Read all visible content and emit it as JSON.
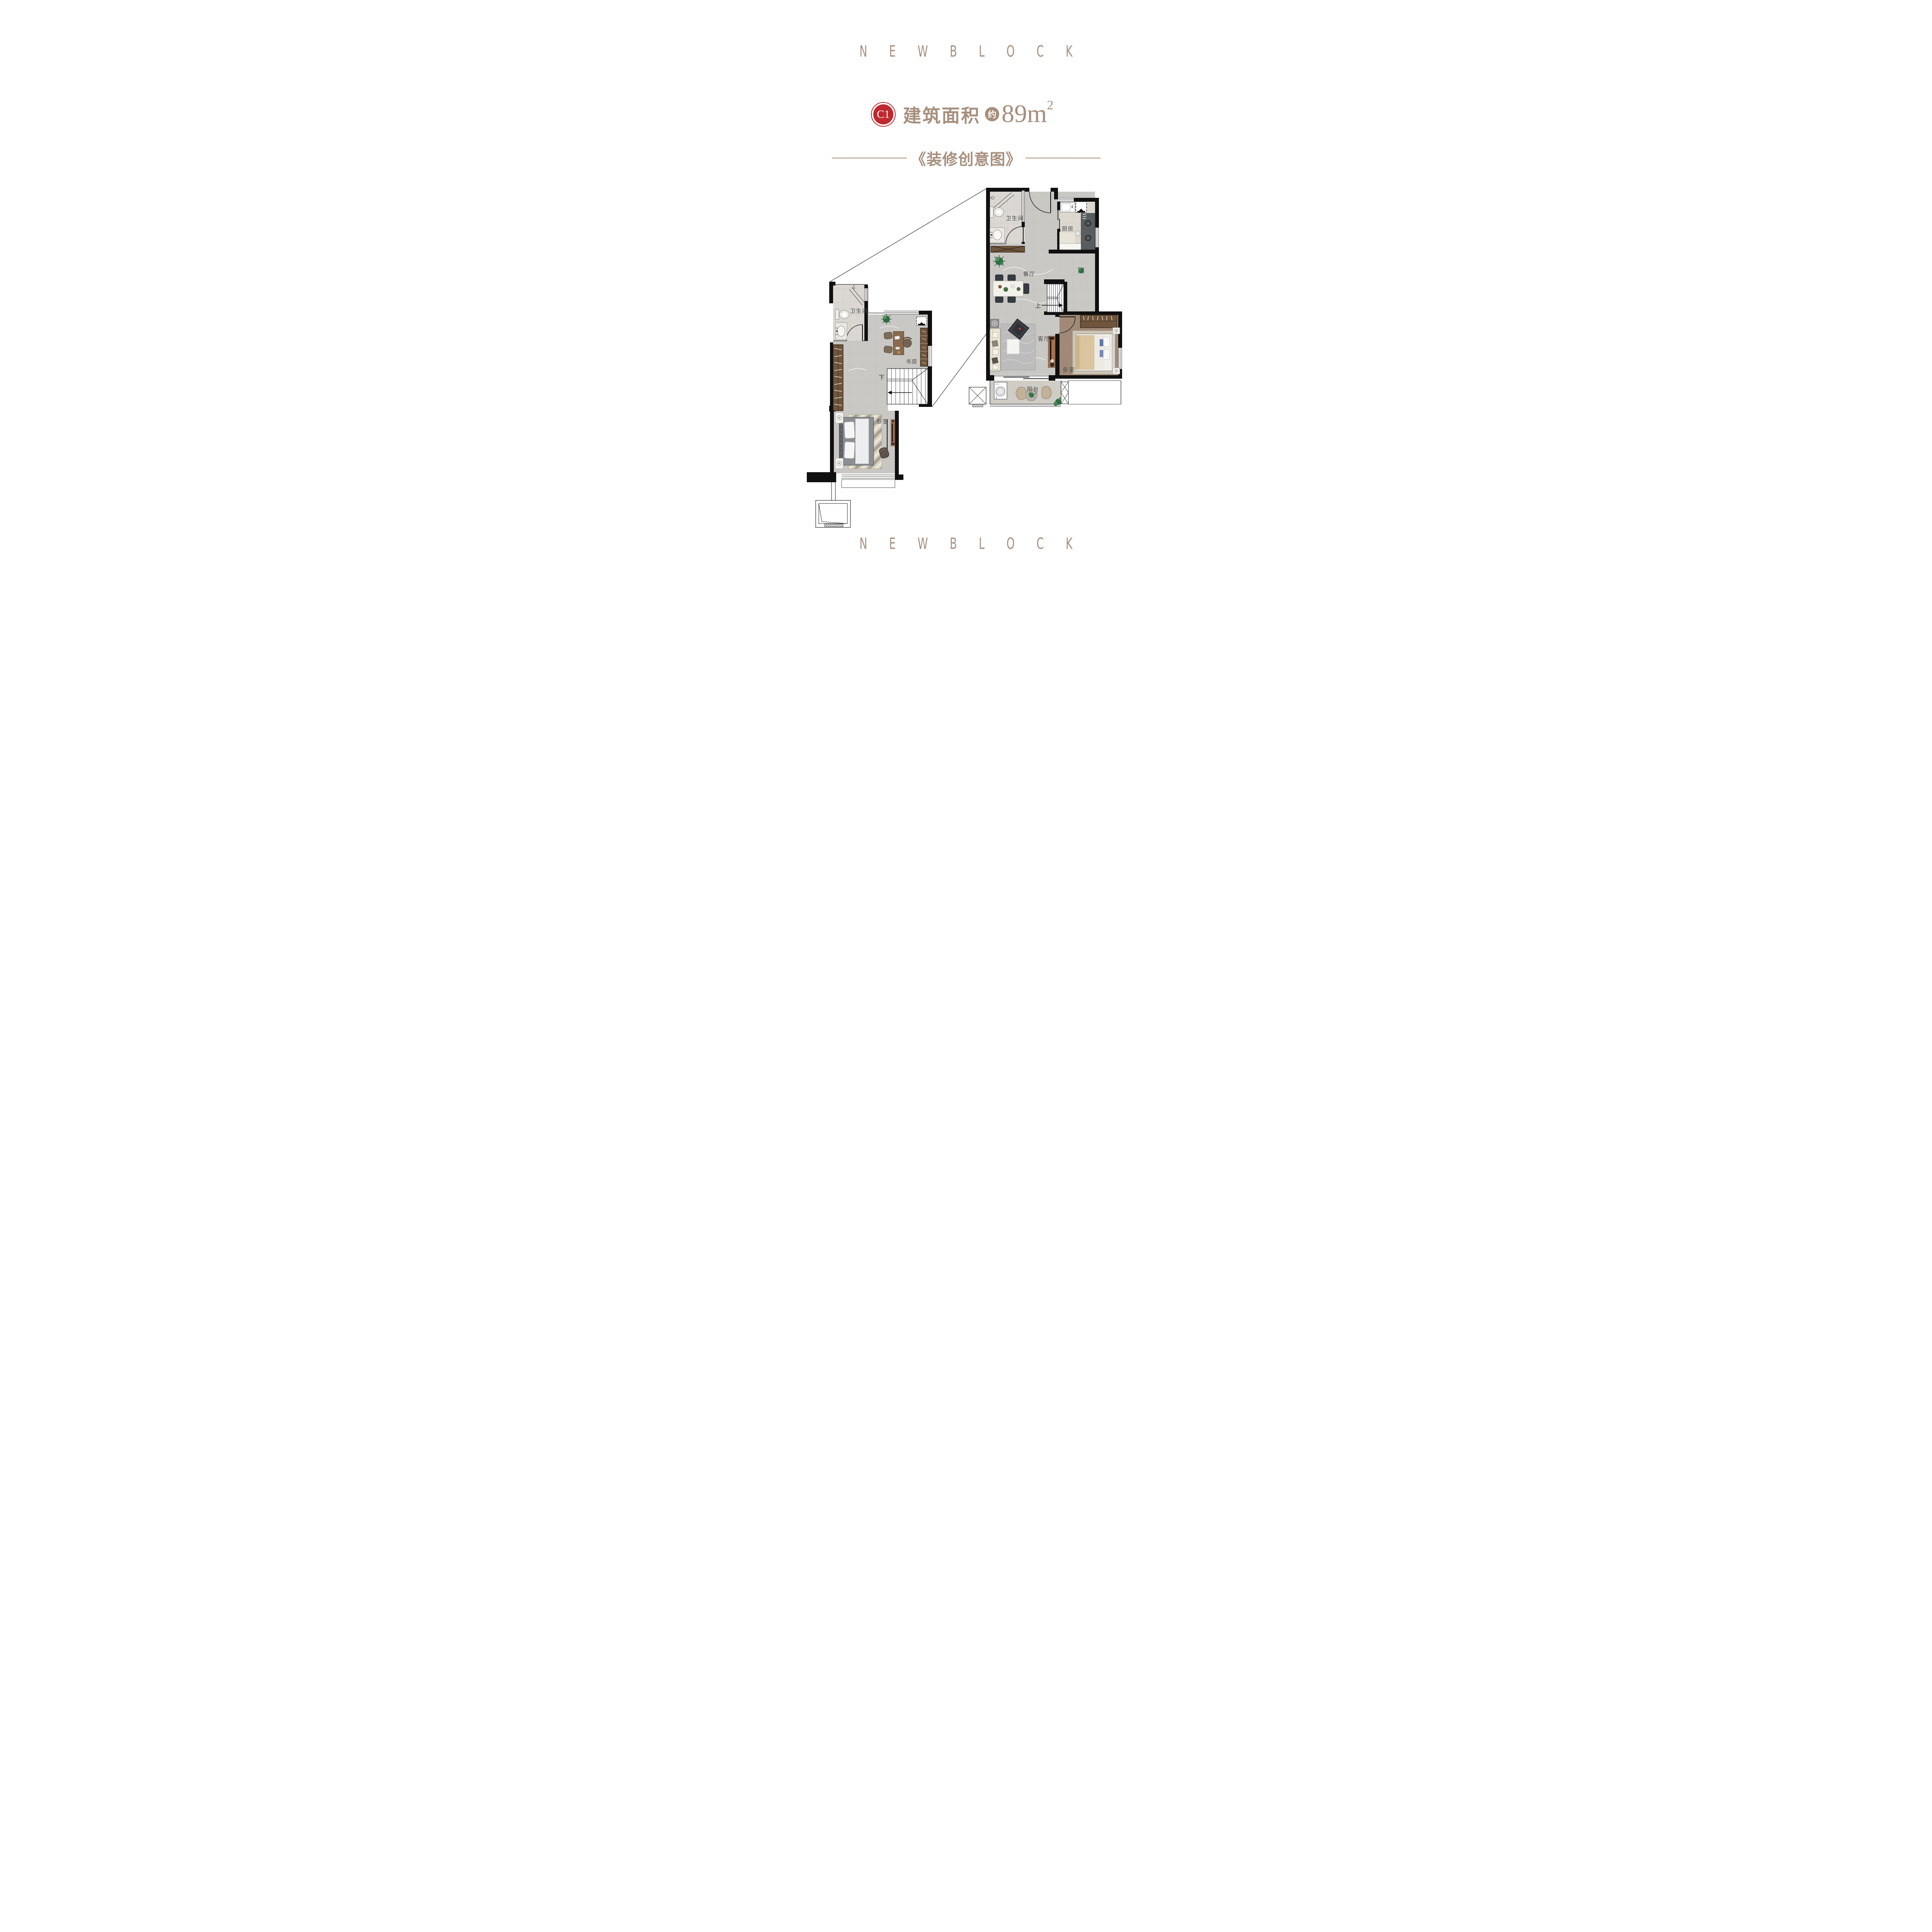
{
  "brand": {
    "top_text": "N E W B L O C K",
    "bottom_text": "N E W B L O C K"
  },
  "header": {
    "unit_code": "C1",
    "area_label": "建筑面积",
    "approx_label": "约",
    "area_number": "89",
    "area_unit": "m",
    "area_exponent": "2",
    "subtitle": "《装修创意图》"
  },
  "upper_plan": {
    "bathroom_label": "卫生间",
    "kitchen_label": "厨房",
    "dining_label": "餐厅",
    "living_label": "客厅",
    "bedroom_label": "卧室",
    "balcony_label": "阳台",
    "stairs_label": "上"
  },
  "lower_plan": {
    "bathroom_label": "卫生间",
    "study_label": "书房",
    "bedroom_label": "卧室",
    "stairs_label": "下"
  },
  "colors": {
    "accent_brown": "#a68f7d",
    "badge_red": "#bf282e",
    "wall_black": "#101010"
  }
}
